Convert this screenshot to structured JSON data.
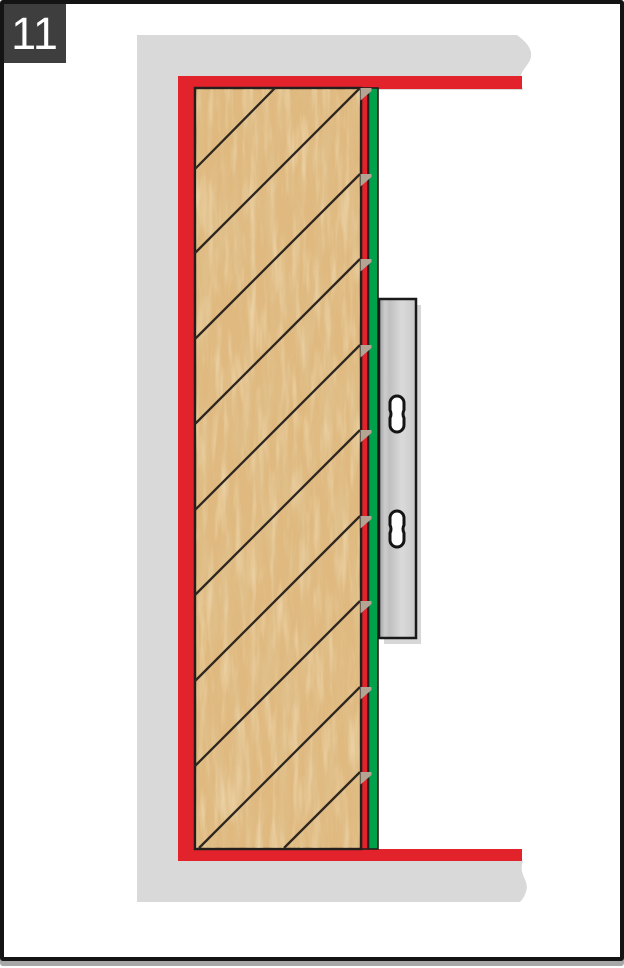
{
  "step": {
    "number": "11"
  },
  "colors": {
    "red": "#e3232b",
    "green": "#00a14b",
    "wall": "#d9d9d9",
    "wood": "#dfb97f",
    "line": "#2e2620",
    "outline": "#241f1c",
    "badge": "#3e3e3e",
    "notch": "#b3a494",
    "rail": "#cccccc",
    "rail_shadow": "#d7d7d7",
    "slot_fill": "#ffffff"
  },
  "diagram": {
    "panel": {
      "x": 195,
      "y": 88,
      "w": 166,
      "h": 761
    },
    "hatch": {
      "right_x": 360,
      "left_x": 195,
      "bottom_y": 848,
      "right_intercepts": [
        88,
        174,
        259,
        345,
        430,
        516,
        601,
        687,
        772
      ],
      "top_stub": {
        "x1": 275,
        "y1": 88,
        "x2": 195,
        "y2": 169
      }
    },
    "notch": {
      "w": 11,
      "h": 12.5
    },
    "rail": {
      "x": 379,
      "y": 299,
      "w": 37,
      "h": 339
    },
    "slots": [
      {
        "cx": 397,
        "cy": 414
      },
      {
        "cx": 397,
        "cy": 529
      }
    ]
  }
}
